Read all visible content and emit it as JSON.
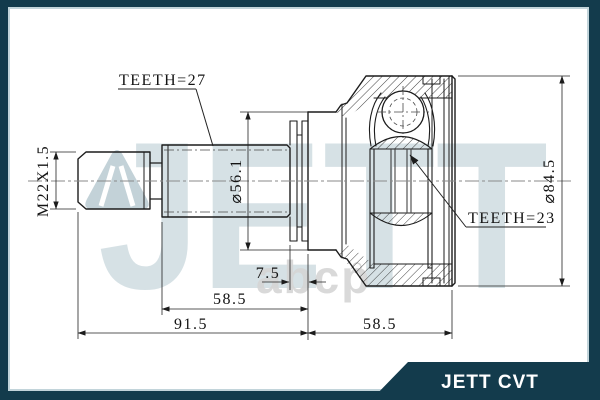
{
  "frame": {
    "brand_color": "#133B4C",
    "accent_line_color": "#C2D4DA"
  },
  "banner": {
    "label": "JETT CVT",
    "text_color": "#FFFFFF"
  },
  "watermark": {
    "brand": "JETT",
    "portal": "abcp",
    "brand_color": "#B6C9D0",
    "portal_color": "#D5D5D5"
  },
  "drawing": {
    "line_color": "#1C1C1C",
    "labels": {
      "teeth_outer": "TEETH=27",
      "teeth_inner": "TEETH=23",
      "thread_spec": "M22X1.5",
      "spline_neck_diameter": "⌀56.1",
      "housing_diameter": "⌀84.5"
    },
    "dimensions": {
      "boot_groove_width": "7.5",
      "spline_to_face_length": "58.5",
      "shaft_overall_length": "91.5",
      "housing_length": "58.5"
    }
  }
}
